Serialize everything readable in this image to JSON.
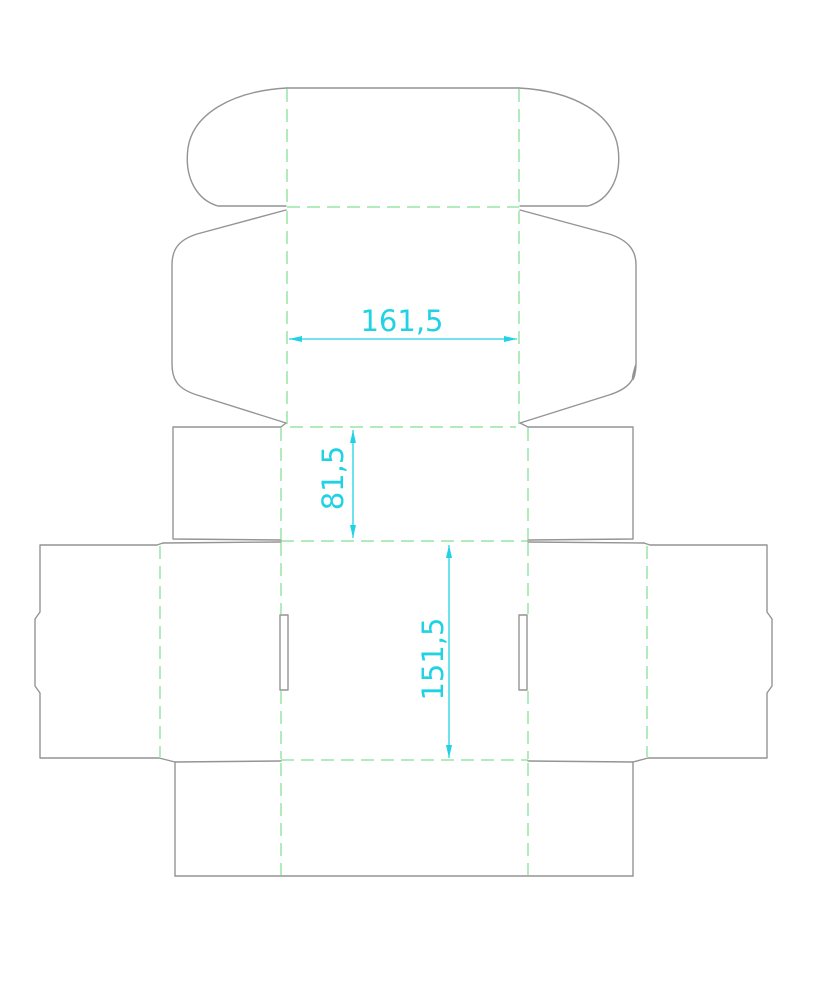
{
  "drawing": {
    "type": "packaging-box-dieline",
    "background": "#ffffff",
    "colors": {
      "cut_line": "#949494",
      "fold_line": "#97e5a6",
      "dimension": "#20d2e4"
    },
    "dimensions": [
      {
        "label": "161,5",
        "orientation": "horizontal"
      },
      {
        "label": "81,5",
        "orientation": "vertical"
      },
      {
        "label": "151,5",
        "orientation": "vertical"
      }
    ]
  }
}
